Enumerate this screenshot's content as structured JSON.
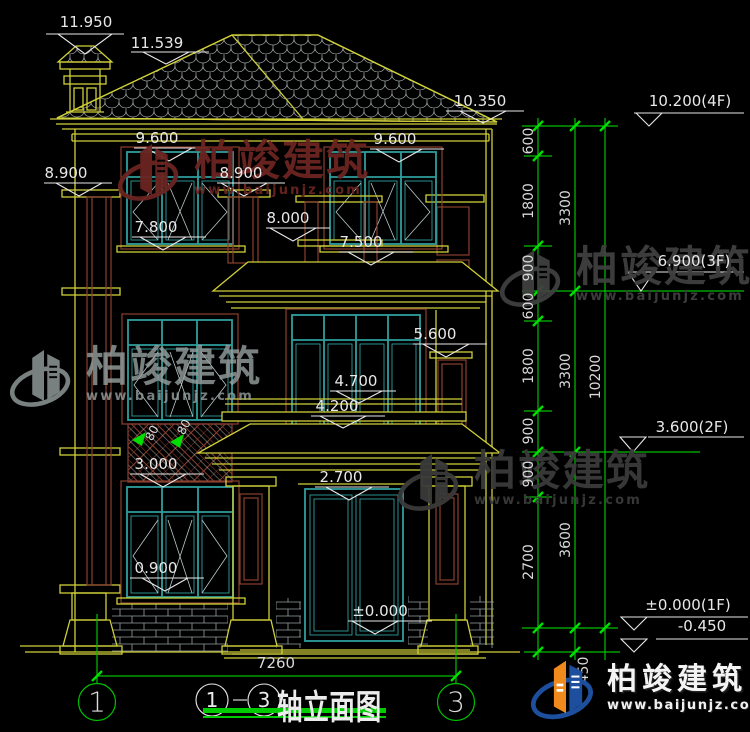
{
  "title": {
    "axis_start": "1",
    "axis_end": "3",
    "label": "轴立面图"
  },
  "axis_bubbles": [
    {
      "label": "1",
      "x": 97,
      "y": 702
    },
    {
      "label": "3",
      "x": 456,
      "y": 702
    }
  ],
  "width_dim": {
    "label": "7260",
    "x": 276,
    "y": 663
  },
  "elevation_markers": [
    {
      "label": "11.950",
      "x": 86,
      "y": 22
    },
    {
      "label": "11.539",
      "x": 157,
      "y": 43
    },
    {
      "label": "10.350",
      "x": 480,
      "y": 101
    },
    {
      "label": "9.600",
      "x": 157,
      "y": 138
    },
    {
      "label": "9.600",
      "x": 395,
      "y": 139
    },
    {
      "label": "8.900",
      "x": 66,
      "y": 173
    },
    {
      "label": "8.900",
      "x": 241,
      "y": 173
    },
    {
      "label": "7.800",
      "x": 156,
      "y": 227
    },
    {
      "label": "8.000",
      "x": 288,
      "y": 218
    },
    {
      "label": "7.500",
      "x": 361,
      "y": 242
    },
    {
      "label": "5.600",
      "x": 435,
      "y": 334
    },
    {
      "label": "4.700",
      "x": 356,
      "y": 381
    },
    {
      "label": "4.200",
      "x": 337,
      "y": 406
    },
    {
      "label": "3.000",
      "x": 156,
      "y": 464
    },
    {
      "label": "2.700",
      "x": 341,
      "y": 477
    },
    {
      "label": "0.900",
      "x": 156,
      "y": 568
    },
    {
      "label": "±0.000",
      "x": 380,
      "y": 611
    }
  ],
  "level_markers": [
    {
      "label": "10.200(4F)",
      "x": 690,
      "y": 101
    },
    {
      "label": "6.900(3F)",
      "x": 694,
      "y": 261
    },
    {
      "label": "3.600(2F)",
      "x": 692,
      "y": 427
    },
    {
      "label": "±0.000(1F)",
      "x": 688,
      "y": 605
    },
    {
      "label": "-0.450",
      "x": 702,
      "y": 626
    }
  ],
  "chain_dims": [
    {
      "label": "600",
      "x": 529,
      "y": 141
    },
    {
      "label": "1800",
      "x": 529,
      "y": 201
    },
    {
      "label": "900",
      "x": 529,
      "y": 268
    },
    {
      "label": "600",
      "x": 529,
      "y": 306
    },
    {
      "label": "1800",
      "x": 529,
      "y": 366
    },
    {
      "label": "900",
      "x": 529,
      "y": 431
    },
    {
      "label": "900",
      "x": 529,
      "y": 474
    },
    {
      "label": "2700",
      "x": 529,
      "y": 562
    },
    {
      "label": "450",
      "x": 584,
      "y": 670
    },
    {
      "label": "3300",
      "x": 566,
      "y": 208
    },
    {
      "label": "3300",
      "x": 566,
      "y": 371
    },
    {
      "label": "3600",
      "x": 566,
      "y": 540
    },
    {
      "label": "10200",
      "x": 596,
      "y": 377
    }
  ],
  "detail_dims": [
    {
      "label": "80",
      "x": 152,
      "y": 433,
      "angle": -62
    },
    {
      "label": "80",
      "x": 184,
      "y": 427,
      "angle": -62
    }
  ],
  "watermarks": [
    {
      "brand": "柏竣建筑",
      "site": "www.baijunjz.com",
      "x": 118,
      "y": 140,
      "color": "#6b2420",
      "opacity": 0.95
    },
    {
      "brand": "柏竣建筑",
      "site": "www.baijunjz.com",
      "x": 500,
      "y": 246,
      "color": "#404040",
      "opacity": 0.95
    },
    {
      "brand": "柏竣建筑",
      "site": "www.baijunjz.com",
      "x": 10,
      "y": 346,
      "color": "#98a0a0",
      "opacity": 0.8
    },
    {
      "brand": "柏竣建筑",
      "site": "www.baijunjz.com",
      "x": 398,
      "y": 450,
      "color": "#3a3a3a",
      "opacity": 0.95
    }
  ],
  "logo": {
    "brand": "柏竣建筑",
    "site": "www.baijunjz.com"
  },
  "colors": {
    "line_yellow": "#cfcf39",
    "frame_teal": "#2f9e9e",
    "trim_brown": "#8a4030",
    "dim_green": "#00c000",
    "tick_green": "#00e000",
    "marker_white": "#e8e8e8",
    "title_underline": "#00cc00",
    "logo_blue": "#1d4f9e",
    "logo_orange": "#f08a1d"
  }
}
